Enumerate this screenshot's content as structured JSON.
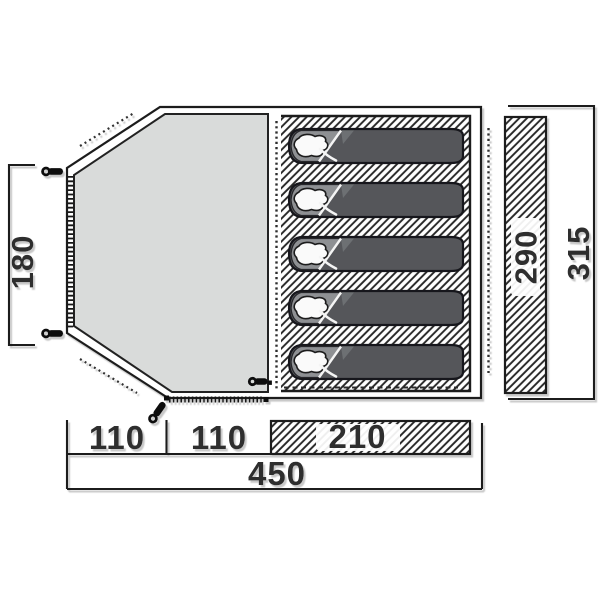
{
  "floorplan": {
    "title": "Tent floorplan diagram",
    "dimensions": {
      "left_height": "180",
      "sleeping_width": "290",
      "total_width": "315",
      "bottom_segment_1": "110",
      "bottom_segment_2": "110",
      "bottom_segment_3": "210",
      "bottom_total": "450"
    },
    "sleeping_bag_count": 5,
    "colors": {
      "outline": "#1c1c1c",
      "living_fill": "#d9dbda",
      "bag_fill": "#54565a",
      "bag_flap_fill": "#8e9093",
      "pillow_fill": "#fafafa",
      "hatch_line": "#262626",
      "label_text": "#2d2d2d",
      "shadow": "#c2c2c2"
    },
    "icons": {
      "peg": "tent-peg-icon",
      "zipper": "zipper-icon",
      "inner_door": "dotted-door-line",
      "guy_line": "guy-line-dotted"
    }
  }
}
